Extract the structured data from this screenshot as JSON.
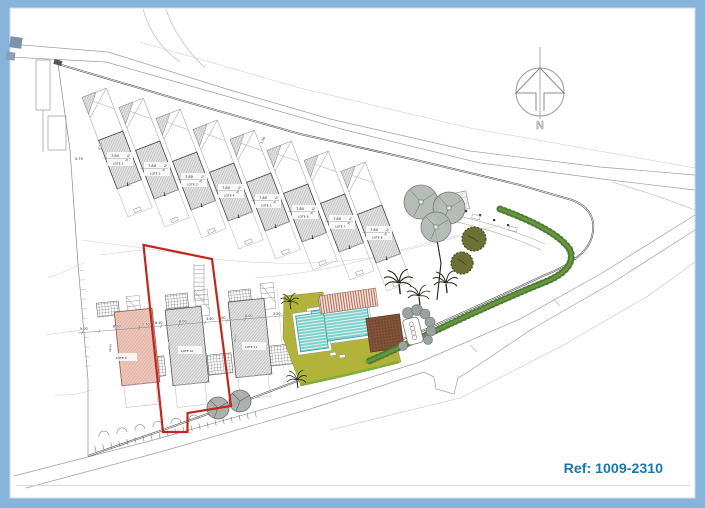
{
  "page": {
    "ref_label": "Ref: 1009-2310",
    "compass_letter": "N",
    "accent_blue": "#1878ae",
    "border_blue": "#87b4da",
    "boundary_red": "#c0271f"
  },
  "plan": {
    "top_lots": [
      {
        "name": "LOTE 1",
        "width": "7.80",
        "depth": "15.15"
      },
      {
        "name": "LOTE 2",
        "width": "7.80",
        "depth": "15.15"
      },
      {
        "name": "LOTE 3",
        "width": "7.80",
        "depth": "15.15"
      },
      {
        "name": "LOTE 4",
        "width": "7.80",
        "depth": "15.15"
      },
      {
        "name": "LOTE 5",
        "width": "7.80",
        "depth": "15.15"
      },
      {
        "name": "LOTE 6",
        "width": "7.80",
        "depth": "15.15"
      },
      {
        "name": "LOTE 7",
        "width": "7.80",
        "depth": "15.15"
      },
      {
        "name": "LOTE 8",
        "width": "7.80",
        "depth": "15.15"
      }
    ],
    "bottom_lots": [
      {
        "name": "LOTE 9",
        "width": "8.00",
        "depth": "14.00"
      },
      {
        "name": "LOTE 10",
        "width": "8.00",
        "depth": "14.00"
      },
      {
        "name": "LOTE 11",
        "width": "8.00",
        "depth": "14.00"
      }
    ],
    "dims": {
      "left_width": "5.75",
      "left_depth": "2.50",
      "road_side": "1.50",
      "path_side": "5.20",
      "bottom_line": [
        "5.00",
        "2.70",
        "6.10",
        "3.50",
        "3.00",
        "3.20"
      ]
    },
    "floor_marker": "1"
  }
}
